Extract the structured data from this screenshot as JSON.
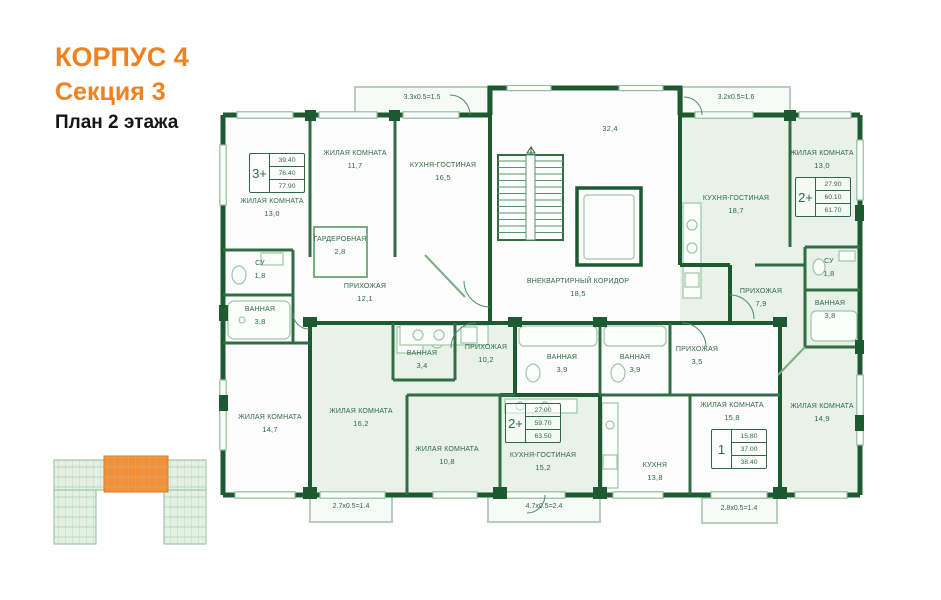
{
  "header": {
    "building": "КОРПУС 4",
    "section": "Секция 3",
    "floor": "План 2 этажа"
  },
  "colors": {
    "accent_orange": "#ef8220",
    "wall_dark_green": "#1d5a31",
    "wall_medium_green": "#2f6e44",
    "room_tint_green": "#e8f2e8",
    "label_green": "#2e6847",
    "minimap_highlight": "#f0913a"
  },
  "plan": {
    "rooms": [
      {
        "name": "ЖИЛАЯ КОМНАТА",
        "area": "13,0",
        "x": 57,
        "y": 112
      },
      {
        "name": "ЖИЛАЯ КОМНАТА",
        "area": "11,7",
        "x": 140,
        "y": 64
      },
      {
        "name": "КУХНЯ-ГОСТИНАЯ",
        "area": "16,5",
        "x": 228,
        "y": 76
      },
      {
        "name": "ГАРДЕРОБНАЯ",
        "area": "2,8",
        "x": 125,
        "y": 150
      },
      {
        "name": "СУ",
        "area": "1,8",
        "x": 45,
        "y": 174
      },
      {
        "name": "ВАННАЯ",
        "area": "3,8",
        "x": 45,
        "y": 220
      },
      {
        "name": "ПРИХОЖАЯ",
        "area": "12,1",
        "x": 150,
        "y": 197
      },
      {
        "name": "ЖИЛАЯ КОМНАТА",
        "area": "14,7",
        "x": 55,
        "y": 328
      },
      {
        "name": "ЖИЛАЯ КОМНАТА",
        "area": "16,2",
        "x": 146,
        "y": 322
      },
      {
        "name": "ВАННАЯ",
        "area": "3,4",
        "x": 207,
        "y": 264
      },
      {
        "name": "ПРИХОЖАЯ",
        "area": "10,2",
        "x": 271,
        "y": 258
      },
      {
        "name": "ВАННАЯ",
        "area": "3,9",
        "x": 347,
        "y": 268
      },
      {
        "name": "ВАННАЯ",
        "area": "3,9",
        "x": 420,
        "y": 268
      },
      {
        "name": "ПРИХОЖАЯ",
        "area": "3,5",
        "x": 482,
        "y": 260
      },
      {
        "name": "ЖИЛАЯ КОМНАТА",
        "area": "10,8",
        "x": 232,
        "y": 360
      },
      {
        "name": "КУХНЯ-ГОСТИНАЯ",
        "area": "15,2",
        "x": 328,
        "y": 366
      },
      {
        "name": "КУХНЯ",
        "area": "13,8",
        "x": 440,
        "y": 376
      },
      {
        "name": "ЖИЛАЯ КОМНАТА",
        "area": "15,8",
        "x": 517,
        "y": 316
      },
      {
        "name": "ЖИЛАЯ КОМНАТА",
        "area": "14,9",
        "x": 607,
        "y": 317
      },
      {
        "name": "КУХНЯ-ГОСТИНАЯ",
        "area": "18,7",
        "x": 521,
        "y": 109
      },
      {
        "name": "ЖИЛАЯ КОМНАТА",
        "area": "13,0",
        "x": 607,
        "y": 64
      },
      {
        "name": "СУ",
        "area": "1,8",
        "x": 614,
        "y": 172
      },
      {
        "name": "ВАННАЯ",
        "area": "3,8",
        "x": 615,
        "y": 214
      },
      {
        "name": "ПРИХОЖАЯ",
        "area": "7,9",
        "x": 546,
        "y": 202
      },
      {
        "name": "ВНЕКВАРТИРНЫЙ КОРИДОР",
        "area": "18,5",
        "x": 363,
        "y": 192
      },
      {
        "name": "",
        "area": "32,4",
        "x": 395,
        "y": 38
      }
    ],
    "balconies": [
      {
        "label": "3.3х0.5=1.5",
        "x": 207,
        "y": 9
      },
      {
        "label": "3.2х0.5=1.6",
        "x": 521,
        "y": 9
      },
      {
        "label": "2.7х0.5=1.4",
        "x": 136,
        "y": 418
      },
      {
        "label": "4.7х0.5=2.4",
        "x": 329,
        "y": 418
      },
      {
        "label": "2.8х0.5=1.4",
        "x": 524,
        "y": 420
      }
    ],
    "stamps": [
      {
        "type": "3+",
        "values": [
          "39.40",
          "76.40",
          "77.90"
        ],
        "x": 34,
        "y": 68
      },
      {
        "type": "2+",
        "values": [
          "27.90",
          "60.10",
          "61.70"
        ],
        "x": 580,
        "y": 92
      },
      {
        "type": "2+",
        "values": [
          "27.00",
          "59.70",
          "63.50"
        ],
        "x": 290,
        "y": 318
      },
      {
        "type": "1",
        "values": [
          "15.80",
          "37.00",
          "38.40"
        ],
        "x": 496,
        "y": 344
      }
    ]
  },
  "minimap": {
    "highlighted_section": "Секция 3"
  }
}
